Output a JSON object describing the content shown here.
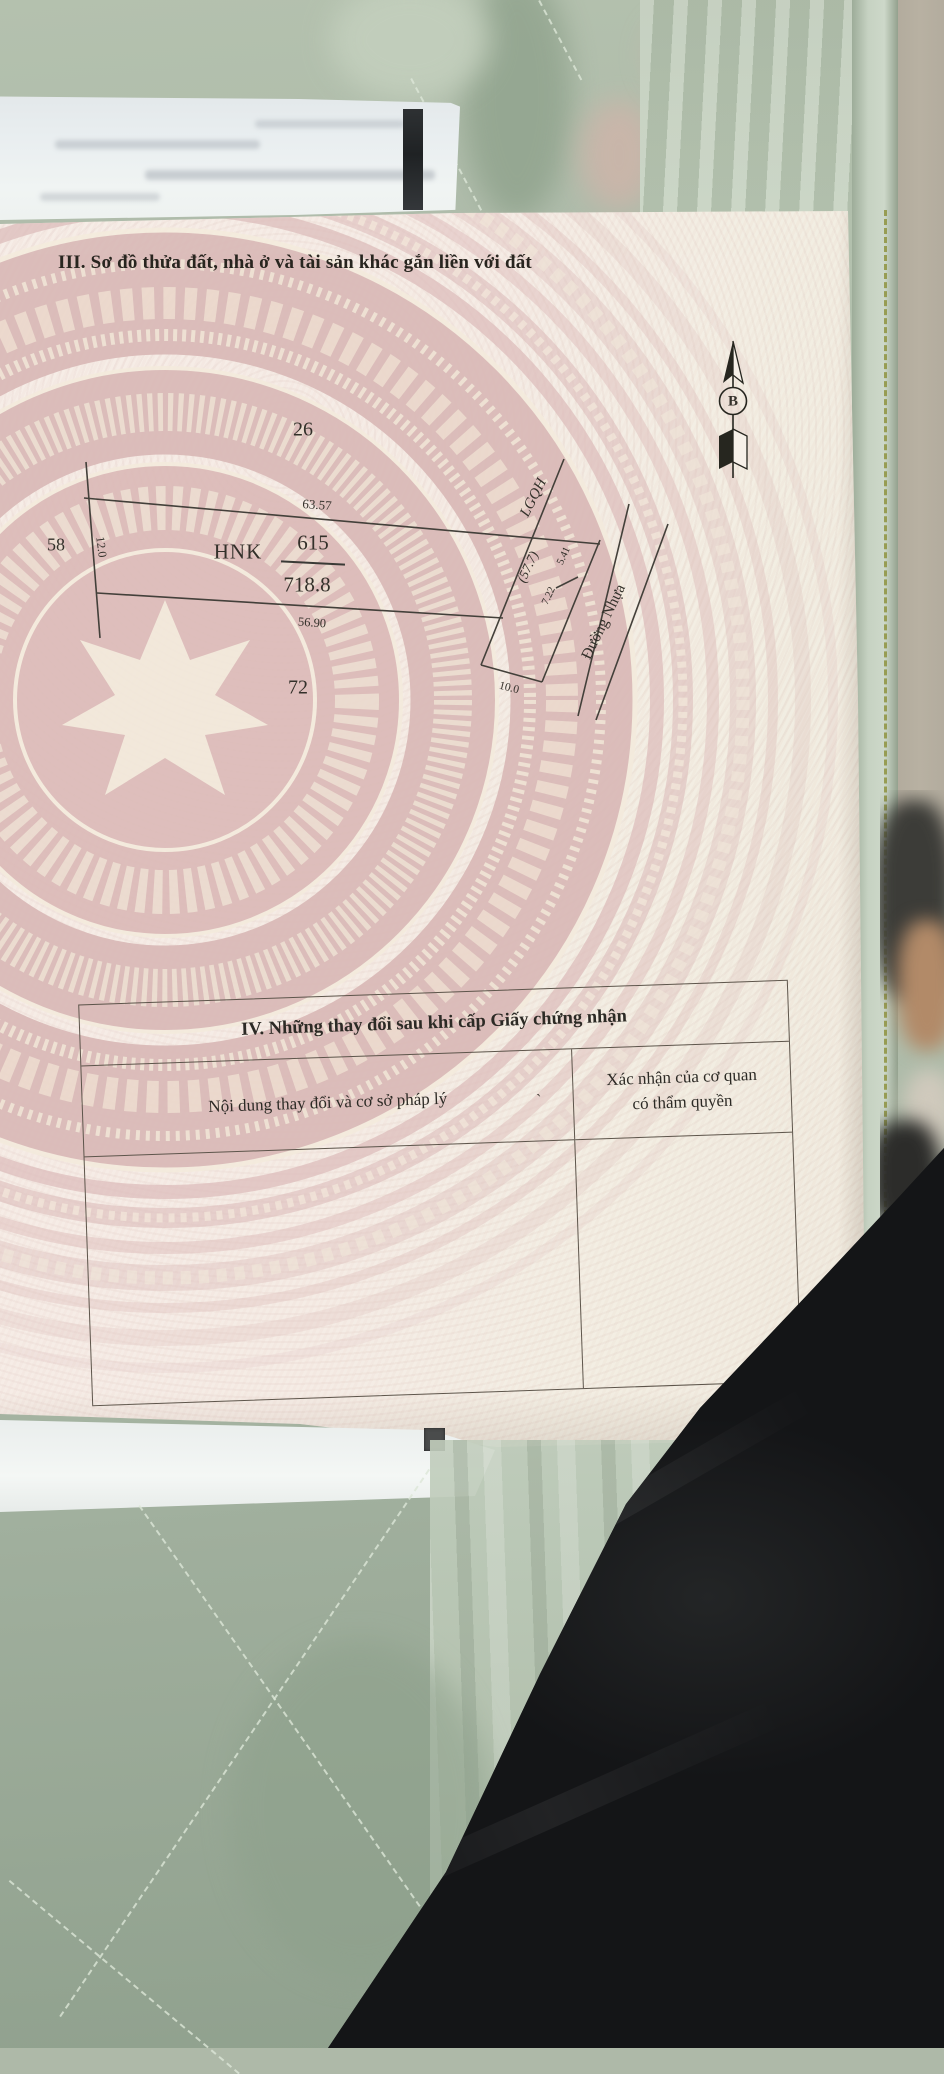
{
  "document": {
    "section3_title": "III. Sơ đồ thửa đất, nhà ở và tài sản khác gắn liền với đất",
    "diagram": {
      "north_label": "B",
      "adjacent_plot_top": "26",
      "adjacent_plot_left": "58",
      "adjacent_plot_bottom": "72",
      "top_edge_length": "63.57",
      "left_edge_length": "12.0",
      "land_use_code": "HNK",
      "parcel_number": "615",
      "parcel_area": "718.8",
      "bottom_edge_length": "56.90",
      "planning_boundary_label": "LGQH",
      "corridor_area": "(57.7)",
      "right_edge_segment_upper": "5.41",
      "right_edge_segment_lower": "7.22",
      "road_name": "Đường Nhựa",
      "road_frontage_length": "10.0"
    },
    "section4": {
      "title": "IV. Những thay đổi sau khi cấp Giấy chứng nhận",
      "col1_header": "Nội dung thay đổi và cơ sở pháp lý",
      "col2_header_line1": "Xác nhận của cơ quan",
      "col2_header_line2": "có thẩm quyền",
      "stray_mark": "`"
    }
  },
  "palette": {
    "paper": "#f5ebe4",
    "drum_pink": "#d9b8b6",
    "quilt_green": "#aebbaa",
    "black_fabric": "#141517",
    "wall_beige": "#b2ab9d"
  }
}
